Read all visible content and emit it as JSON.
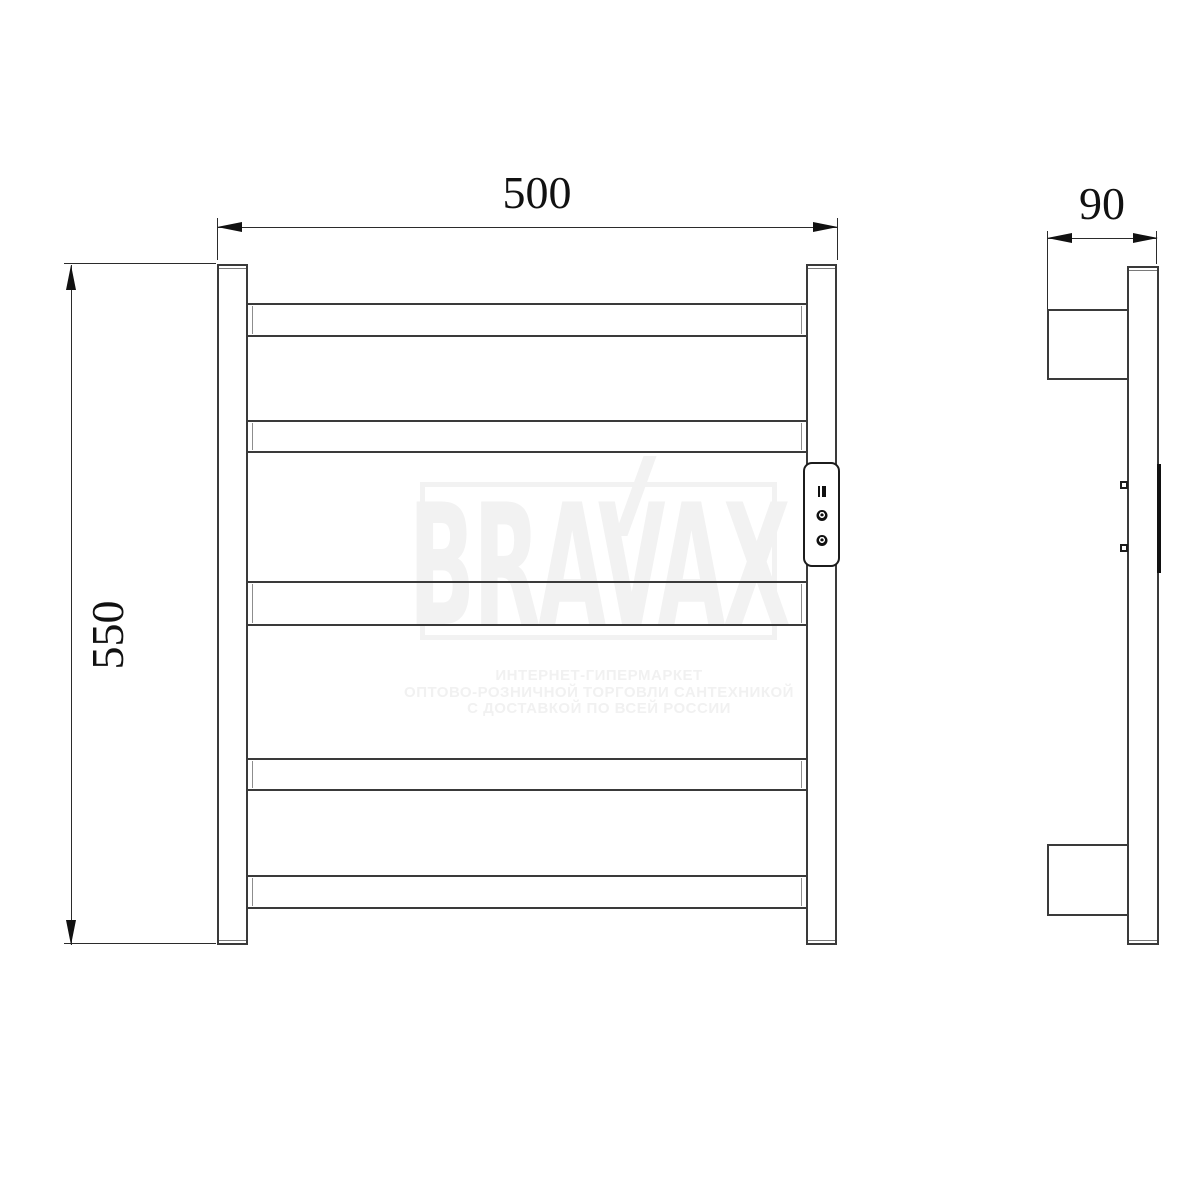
{
  "watermark": {
    "brand": "BRAVAX",
    "color": "#f2f2f2",
    "tagline": {
      "line1": "ИНТЕРНЕТ-ГИПЕРМАРКЕТ",
      "line2": "ОПТОВО-РОЗНИЧНОЙ ТОРГОВЛИ САНТЕХНИКОЙ",
      "line3": "С ДОСТАВКОЙ ПО ВСЕЙ РОССИИ"
    }
  },
  "dimensions": {
    "width_label": "500",
    "height_label": "550",
    "depth_label": "90"
  },
  "drawing": {
    "line_color": "#3a3a3a",
    "bar_count": 5,
    "panel_icons": [
      "display-icon",
      "knob-icon",
      "knob-icon"
    ]
  }
}
